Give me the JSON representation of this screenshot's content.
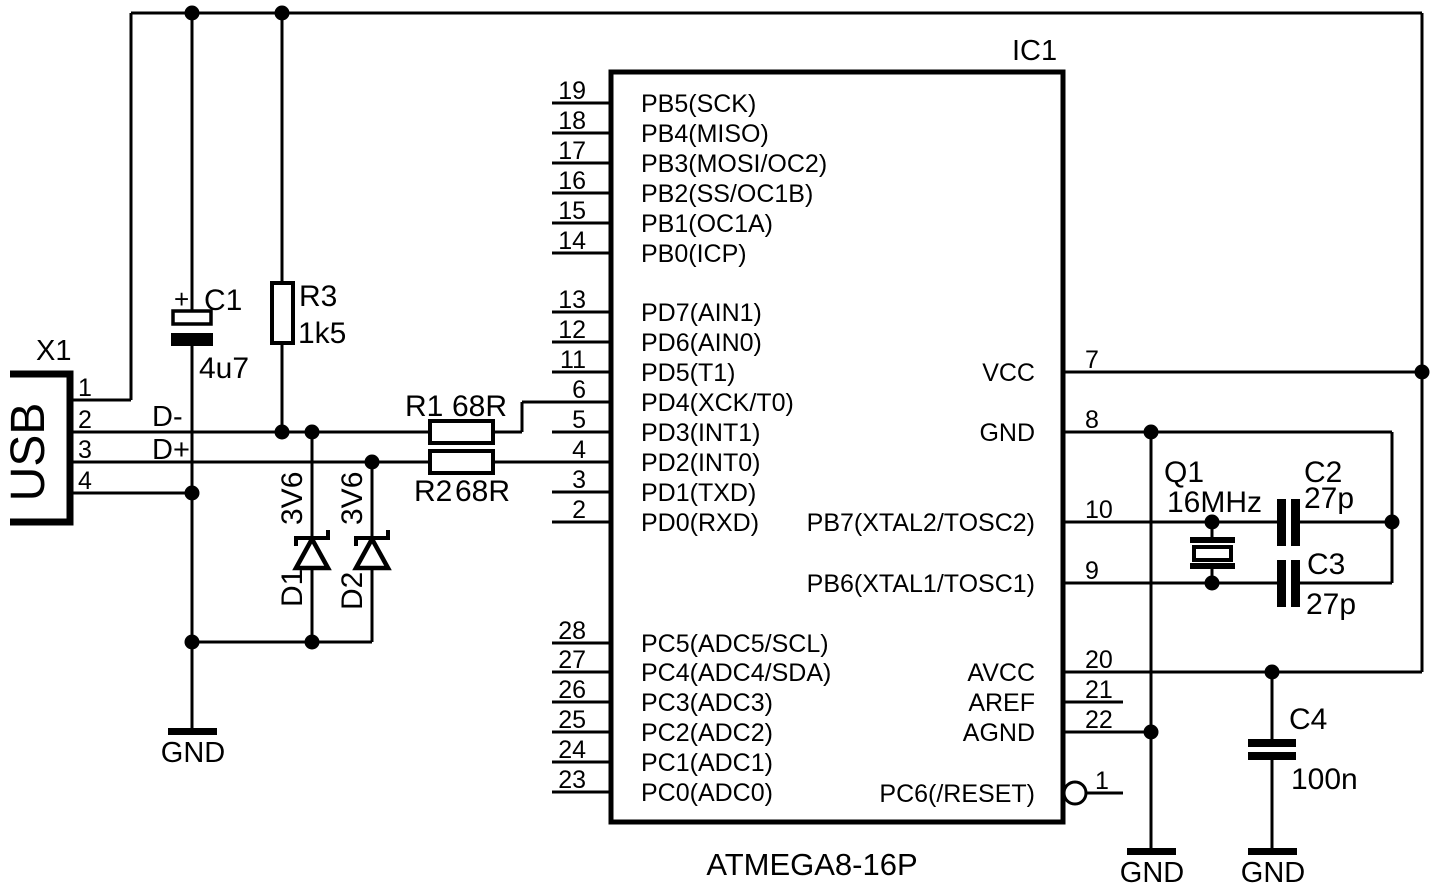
{
  "schematic": {
    "ic": {
      "ref": "IC1",
      "part": "ATMEGA8-16P",
      "left_pins": [
        {
          "num": "19",
          "name": "PB5(SCK)"
        },
        {
          "num": "18",
          "name": "PB4(MISO)"
        },
        {
          "num": "17",
          "name": "PB3(MOSI/OC2)"
        },
        {
          "num": "16",
          "name": "PB2(SS/OC1B)"
        },
        {
          "num": "15",
          "name": "PB1(OC1A)"
        },
        {
          "num": "14",
          "name": "PB0(ICP)"
        },
        {
          "num": "13",
          "name": "PD7(AIN1)"
        },
        {
          "num": "12",
          "name": "PD6(AIN0)"
        },
        {
          "num": "11",
          "name": "PD5(T1)"
        },
        {
          "num": "6",
          "name": "PD4(XCK/T0)"
        },
        {
          "num": "5",
          "name": "PD3(INT1)"
        },
        {
          "num": "4",
          "name": "PD2(INT0)"
        },
        {
          "num": "3",
          "name": "PD1(TXD)"
        },
        {
          "num": "2",
          "name": "PD0(RXD)"
        },
        {
          "num": "28",
          "name": "PC5(ADC5/SCL)"
        },
        {
          "num": "27",
          "name": "PC4(ADC4/SDA)"
        },
        {
          "num": "26",
          "name": "PC3(ADC3)"
        },
        {
          "num": "25",
          "name": "PC2(ADC2)"
        },
        {
          "num": "24",
          "name": "PC1(ADC1)"
        },
        {
          "num": "23",
          "name": "PC0(ADC0)"
        }
      ],
      "right_pins": [
        {
          "num": "7",
          "name": "VCC"
        },
        {
          "num": "8",
          "name": "GND"
        },
        {
          "num": "10",
          "name": "PB7(XTAL2/TOSC2)"
        },
        {
          "num": "9",
          "name": "PB6(XTAL1/TOSC1)"
        },
        {
          "num": "20",
          "name": "AVCC"
        },
        {
          "num": "21",
          "name": "AREF"
        },
        {
          "num": "22",
          "name": "AGND"
        },
        {
          "num": "1",
          "name": "PC6(/RESET)"
        }
      ]
    },
    "usb": {
      "ref": "X1",
      "label": "USB",
      "pin_numbers": [
        "1",
        "2",
        "3",
        "4"
      ],
      "d_minus": "D-",
      "d_plus": "D+"
    },
    "components": {
      "c1": {
        "ref": "C1",
        "value": "4u7",
        "polarity": "+"
      },
      "r3": {
        "ref": "R3",
        "value": "1k5"
      },
      "r1": {
        "ref": "R1",
        "value": "68R"
      },
      "r2": {
        "ref": "R2",
        "value": "68R"
      },
      "d1": {
        "ref": "D1",
        "value": "3V6"
      },
      "d2": {
        "ref": "D2",
        "value": "3V6"
      },
      "q1": {
        "ref": "Q1",
        "value": "16MHz"
      },
      "c2": {
        "ref": "C2",
        "value": "27p"
      },
      "c3": {
        "ref": "C3",
        "value": "27p"
      },
      "c4": {
        "ref": "C4",
        "value": "100n"
      }
    },
    "ground_label": "GND",
    "colors": {
      "line": "#000000",
      "background": "#ffffff"
    }
  }
}
